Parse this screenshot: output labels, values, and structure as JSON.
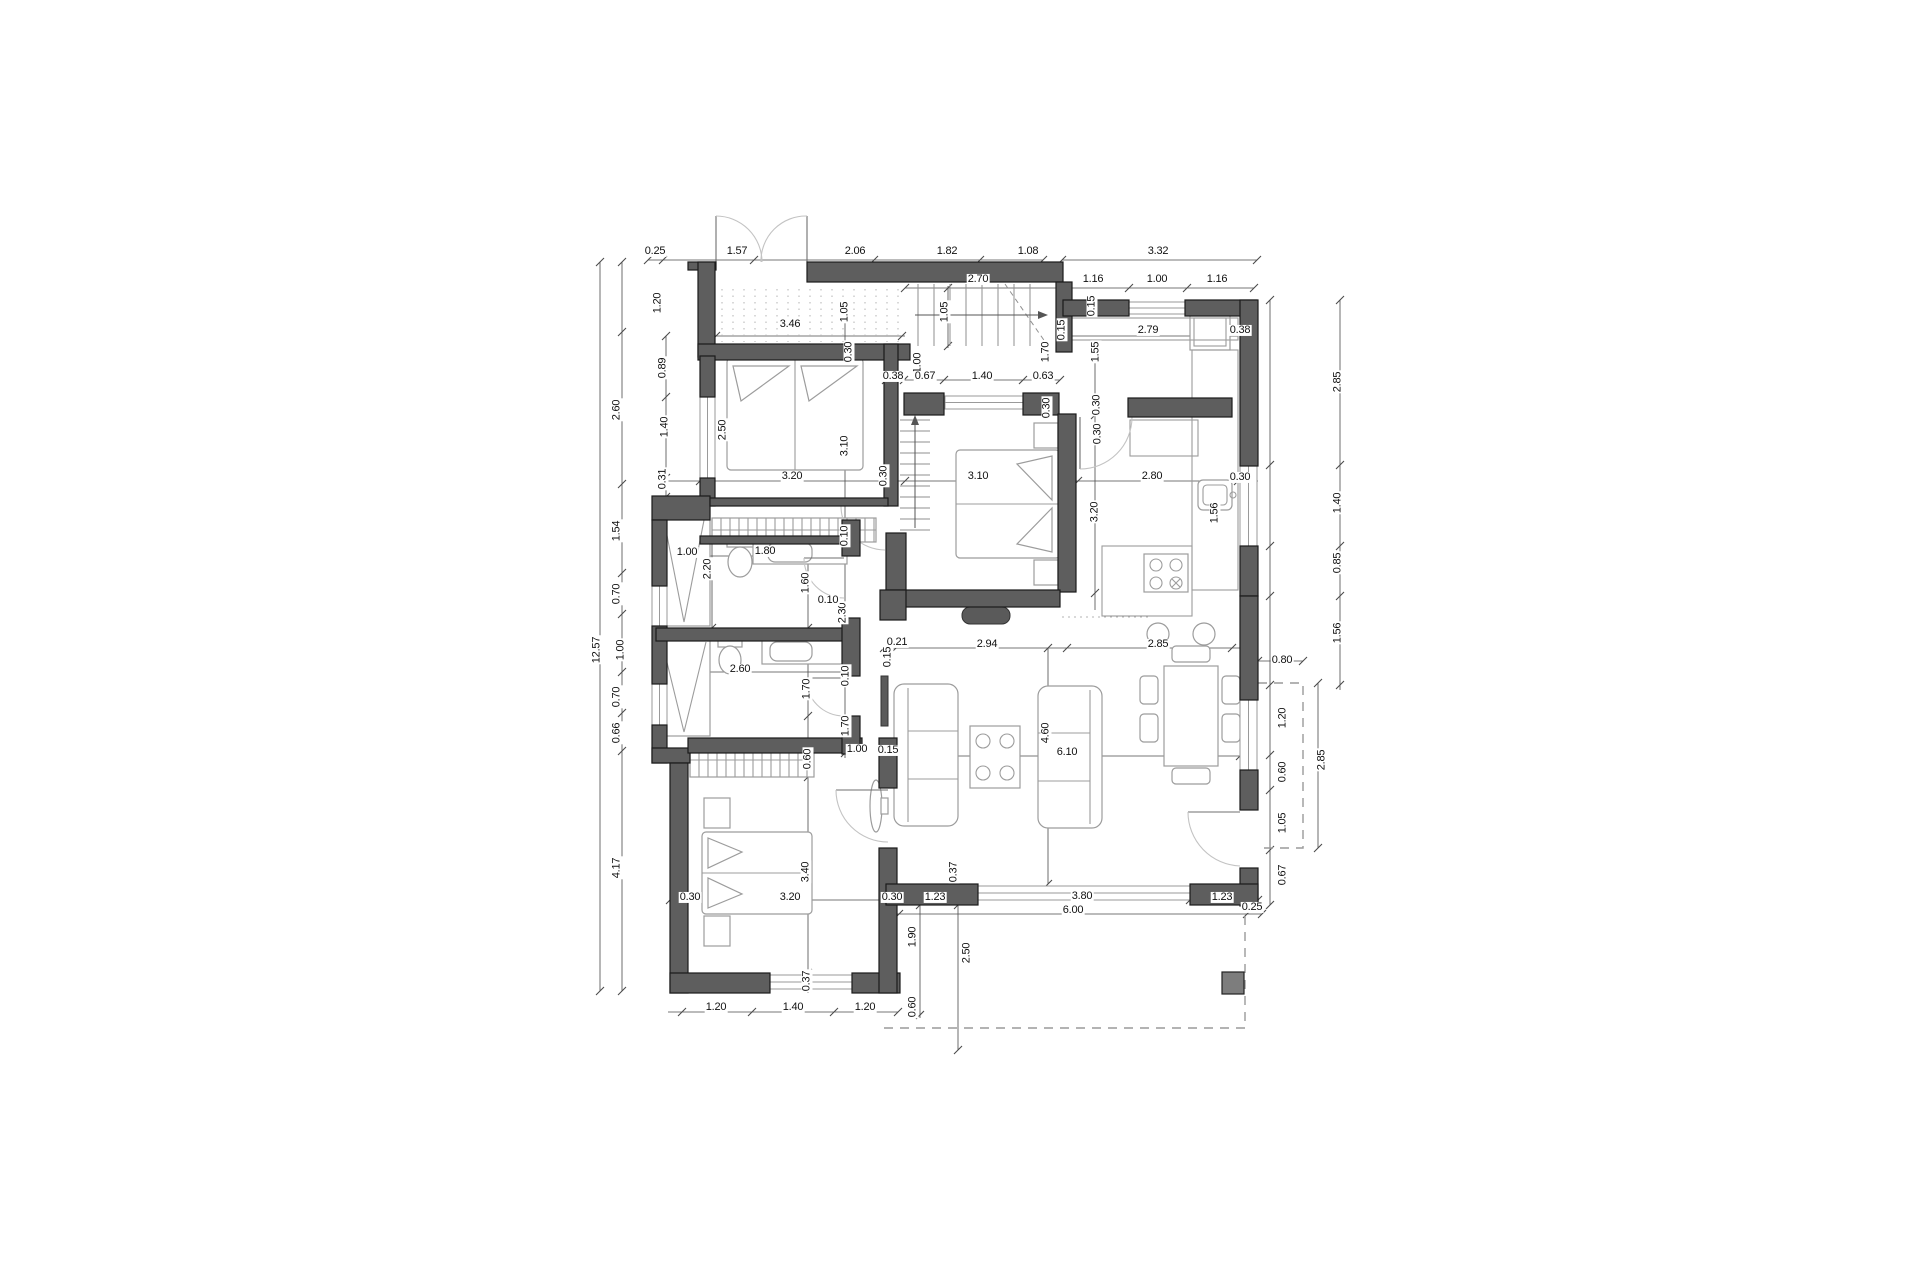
{
  "title": "floor-plan-drawing",
  "colors": {
    "background": "#ffffff",
    "wall_fill": "#5e5e5e",
    "wall_stroke": "#1a1a1a",
    "furniture_line": "#9c9c9c",
    "window_line": "#9a9a9a",
    "door_arc": "#c3c3c3",
    "dim_line": "#4a4a4a",
    "dim_text": "#111111",
    "column_fill": "#7d7d7d"
  },
  "dimensions": [
    {
      "t": "0.25",
      "x": 655,
      "y": 252,
      "r": 0
    },
    {
      "t": "1.57",
      "x": 737,
      "y": 252,
      "r": 0
    },
    {
      "t": "2.06",
      "x": 855,
      "y": 252,
      "r": 0
    },
    {
      "t": "1.82",
      "x": 947,
      "y": 252,
      "r": 0
    },
    {
      "t": "1.08",
      "x": 1028,
      "y": 252,
      "r": 0
    },
    {
      "t": "3.32",
      "x": 1158,
      "y": 252,
      "r": 0
    },
    {
      "t": "2.70",
      "x": 978,
      "y": 280,
      "r": 0
    },
    {
      "t": "1.16",
      "x": 1093,
      "y": 280,
      "r": 0
    },
    {
      "t": "1.00",
      "x": 1157,
      "y": 280,
      "r": 0
    },
    {
      "t": "1.16",
      "x": 1217,
      "y": 280,
      "r": 0
    },
    {
      "t": "3.46",
      "x": 790,
      "y": 325,
      "r": 0
    },
    {
      "t": "1.05",
      "x": 845,
      "y": 312,
      "r": 1
    },
    {
      "t": "1.05",
      "x": 945,
      "y": 312,
      "r": 1
    },
    {
      "t": "0.30",
      "x": 849,
      "y": 352,
      "r": 1
    },
    {
      "t": "0.15",
      "x": 1092,
      "y": 306,
      "r": 1
    },
    {
      "t": "0.15",
      "x": 1062,
      "y": 330,
      "r": 1
    },
    {
      "t": "1.70",
      "x": 1046,
      "y": 352,
      "r": 1
    },
    {
      "t": "1.55",
      "x": 1096,
      "y": 352,
      "r": 1
    },
    {
      "t": "2.79",
      "x": 1148,
      "y": 331,
      "r": 0
    },
    {
      "t": "0.38",
      "x": 1240,
      "y": 331,
      "r": 0
    },
    {
      "t": "0.30",
      "x": 1097,
      "y": 405,
      "r": 1
    },
    {
      "t": "12.57",
      "x": 597,
      "y": 650,
      "r": 1
    },
    {
      "t": "1.20",
      "x": 658,
      "y": 303,
      "r": 1
    },
    {
      "t": "0.89",
      "x": 663,
      "y": 368,
      "r": 1
    },
    {
      "t": "2.60",
      "x": 617,
      "y": 410,
      "r": 1
    },
    {
      "t": "1.40",
      "x": 665,
      "y": 427,
      "r": 1
    },
    {
      "t": "0.31",
      "x": 663,
      "y": 479,
      "r": 1
    },
    {
      "t": "1.54",
      "x": 617,
      "y": 531,
      "r": 1
    },
    {
      "t": "0.70",
      "x": 617,
      "y": 594,
      "r": 1
    },
    {
      "t": "1.00",
      "x": 621,
      "y": 650,
      "r": 1
    },
    {
      "t": "0.70",
      "x": 617,
      "y": 697,
      "r": 1
    },
    {
      "t": "0.66",
      "x": 617,
      "y": 733,
      "r": 1
    },
    {
      "t": "4.17",
      "x": 617,
      "y": 868,
      "r": 1
    },
    {
      "t": "2.50",
      "x": 723,
      "y": 430,
      "r": 1
    },
    {
      "t": "3.10",
      "x": 845,
      "y": 446,
      "r": 1
    },
    {
      "t": "3.20",
      "x": 792,
      "y": 477,
      "r": 0
    },
    {
      "t": "0.30",
      "x": 884,
      "y": 476,
      "r": 1
    },
    {
      "t": "1.00",
      "x": 918,
      "y": 363,
      "r": 1
    },
    {
      "t": "0.38",
      "x": 893,
      "y": 377,
      "r": 0
    },
    {
      "t": "0.67",
      "x": 925,
      "y": 377,
      "r": 0
    },
    {
      "t": "1.40",
      "x": 982,
      "y": 377,
      "r": 0
    },
    {
      "t": "0.63",
      "x": 1043,
      "y": 377,
      "r": 0
    },
    {
      "t": "0.30",
      "x": 1047,
      "y": 408,
      "r": 1
    },
    {
      "t": "0.30",
      "x": 1098,
      "y": 434,
      "r": 1
    },
    {
      "t": "3.10",
      "x": 978,
      "y": 477,
      "r": 0
    },
    {
      "t": "3.20",
      "x": 1095,
      "y": 512,
      "r": 1
    },
    {
      "t": "0.10",
      "x": 845,
      "y": 536,
      "r": 1
    },
    {
      "t": "2.30",
      "x": 843,
      "y": 613,
      "r": 1
    },
    {
      "t": "0.10",
      "x": 828,
      "y": 601,
      "r": 0
    },
    {
      "t": "2.80",
      "x": 1152,
      "y": 477,
      "r": 0
    },
    {
      "t": "0.30",
      "x": 1240,
      "y": 478,
      "r": 0
    },
    {
      "t": "1.56",
      "x": 1215,
      "y": 513,
      "r": 1
    },
    {
      "t": "2.85",
      "x": 1338,
      "y": 382,
      "r": 1
    },
    {
      "t": "1.40",
      "x": 1338,
      "y": 503,
      "r": 1
    },
    {
      "t": "0.85",
      "x": 1338,
      "y": 563,
      "r": 1
    },
    {
      "t": "1.56",
      "x": 1338,
      "y": 633,
      "r": 1
    },
    {
      "t": "0.80",
      "x": 1282,
      "y": 661,
      "r": 0
    },
    {
      "t": "1.20",
      "x": 1283,
      "y": 718,
      "r": 1
    },
    {
      "t": "0.60",
      "x": 1283,
      "y": 772,
      "r": 1
    },
    {
      "t": "1.05",
      "x": 1283,
      "y": 823,
      "r": 1
    },
    {
      "t": "0.67",
      "x": 1283,
      "y": 875,
      "r": 1
    },
    {
      "t": "2.85",
      "x": 1322,
      "y": 760,
      "r": 1
    },
    {
      "t": "1.00",
      "x": 687,
      "y": 553,
      "r": 0
    },
    {
      "t": "1.80",
      "x": 765,
      "y": 552,
      "r": 0
    },
    {
      "t": "2.20",
      "x": 708,
      "y": 569,
      "r": 1
    },
    {
      "t": "1.60",
      "x": 806,
      "y": 583,
      "r": 1
    },
    {
      "t": "2.60",
      "x": 740,
      "y": 670,
      "r": 0
    },
    {
      "t": "1.70",
      "x": 807,
      "y": 689,
      "r": 1
    },
    {
      "t": "0.10",
      "x": 846,
      "y": 676,
      "r": 1
    },
    {
      "t": "1.70",
      "x": 846,
      "y": 726,
      "r": 1
    },
    {
      "t": "1.00",
      "x": 857,
      "y": 750,
      "r": 0
    },
    {
      "t": "0.15",
      "x": 888,
      "y": 751,
      "r": 0
    },
    {
      "t": "0.60",
      "x": 808,
      "y": 759,
      "r": 1
    },
    {
      "t": "0.21",
      "x": 897,
      "y": 643,
      "r": 0
    },
    {
      "t": "2.94",
      "x": 987,
      "y": 645,
      "r": 0
    },
    {
      "t": "2.85",
      "x": 1158,
      "y": 645,
      "r": 0
    },
    {
      "t": "0.15",
      "x": 888,
      "y": 657,
      "r": 1
    },
    {
      "t": "4.60",
      "x": 1046,
      "y": 733,
      "r": 1
    },
    {
      "t": "6.10",
      "x": 1067,
      "y": 753,
      "r": 0
    },
    {
      "t": "0.37",
      "x": 954,
      "y": 872,
      "r": 1
    },
    {
      "t": "0.30",
      "x": 892,
      "y": 898,
      "r": 0
    },
    {
      "t": "1.23",
      "x": 935,
      "y": 898,
      "r": 0
    },
    {
      "t": "3.80",
      "x": 1082,
      "y": 897,
      "r": 0
    },
    {
      "t": "1.23",
      "x": 1222,
      "y": 898,
      "r": 0
    },
    {
      "t": "6.00",
      "x": 1073,
      "y": 911,
      "r": 0
    },
    {
      "t": "0.25",
      "x": 1252,
      "y": 908,
      "r": 0
    },
    {
      "t": "3.40",
      "x": 806,
      "y": 872,
      "r": 1
    },
    {
      "t": "3.20",
      "x": 790,
      "y": 898,
      "r": 0
    },
    {
      "t": "0.30",
      "x": 690,
      "y": 898,
      "r": 0
    },
    {
      "t": "0.37",
      "x": 807,
      "y": 981,
      "r": 1
    },
    {
      "t": "1.20",
      "x": 716,
      "y": 1008,
      "r": 0
    },
    {
      "t": "1.40",
      "x": 793,
      "y": 1008,
      "r": 0
    },
    {
      "t": "1.20",
      "x": 865,
      "y": 1008,
      "r": 0
    },
    {
      "t": "1.90",
      "x": 913,
      "y": 937,
      "r": 1
    },
    {
      "t": "2.50",
      "x": 967,
      "y": 953,
      "r": 1
    },
    {
      "t": "0.60",
      "x": 913,
      "y": 1007,
      "r": 1
    }
  ]
}
